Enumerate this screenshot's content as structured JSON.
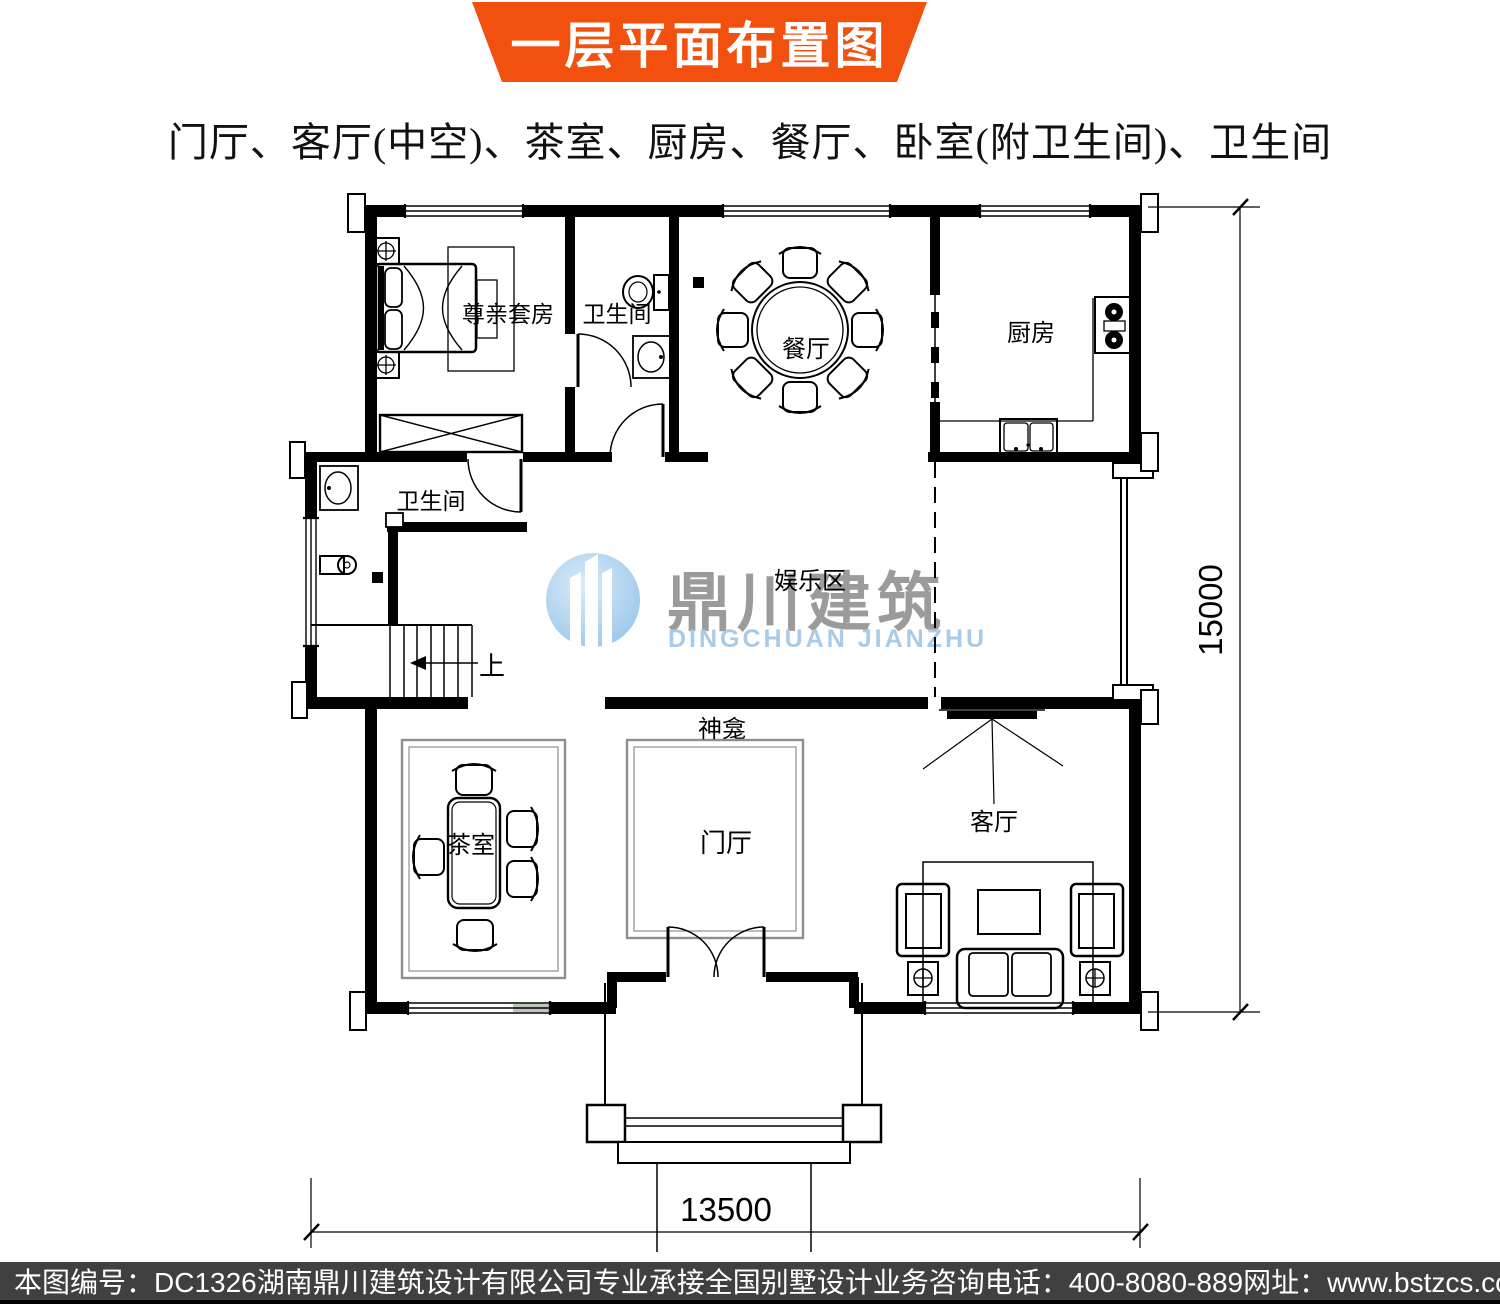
{
  "banner": {
    "title": "一层平面布置图",
    "bg_color": "#F1500E"
  },
  "subtitle": "门厅、客厅(中空)、茶室、厨房、餐厅、卧室(附卫生间)、卫生间",
  "plan": {
    "rooms": {
      "master_suite": "尊亲套房",
      "bath_top": "卫生间",
      "dining": "餐厅",
      "kitchen": "厨房",
      "bath_mid": "卫生间",
      "stairs_up": "上",
      "entertainment": "娱乐区",
      "shrine": "神龛",
      "foyer": "门厅",
      "living": "客厅",
      "tea_room": "茶室"
    },
    "dimensions": {
      "right": "15000",
      "bottom": "13500"
    }
  },
  "watermark": {
    "cn": "鼎川建筑",
    "en": "DINGCHUAN JIANZHU",
    "gray": "#9b9b9b",
    "blue": "#a9cbe7"
  },
  "footer": {
    "drawing_no": "本图编号：DC1326",
    "company": "湖南鼎川建筑设计有限公司专业承接全国别墅设计业务",
    "phone": "咨询电话：400-8080-889",
    "website": "网址：www.bstzcs.com"
  }
}
